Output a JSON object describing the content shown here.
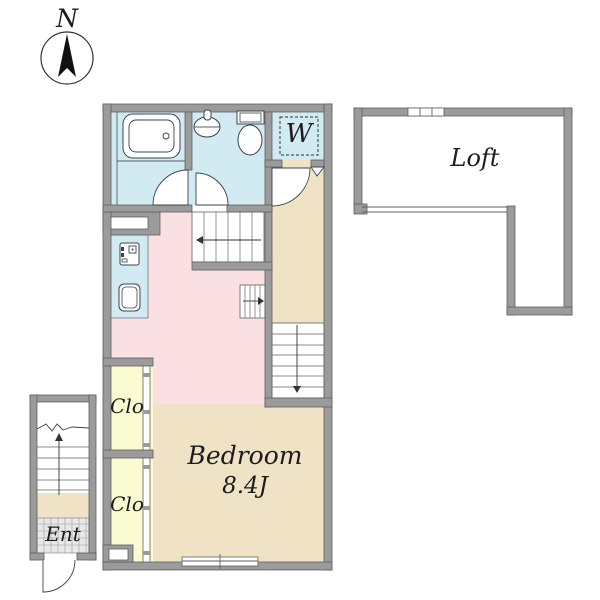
{
  "title": "Apartment floor plan with loft",
  "compass": {
    "label": "N"
  },
  "rooms": {
    "loft": {
      "label": "Loft"
    },
    "bedroom": {
      "label": "Bedroom",
      "size": "8.4J"
    },
    "closet_upper": {
      "label": "Clo"
    },
    "closet_lower": {
      "label": "Clo"
    },
    "washer": {
      "label": "W"
    },
    "entrance": {
      "label": "Ent"
    }
  },
  "colors": {
    "wall": "#9b9b9b",
    "wet": "#d2ebf2",
    "dk_pink": "#fadfe3",
    "tan": "#f0e2c4",
    "closet_yellow": "#fbfbd2",
    "tile": "#e8e8e8",
    "white": "#ffffff",
    "needle": "#111111"
  }
}
